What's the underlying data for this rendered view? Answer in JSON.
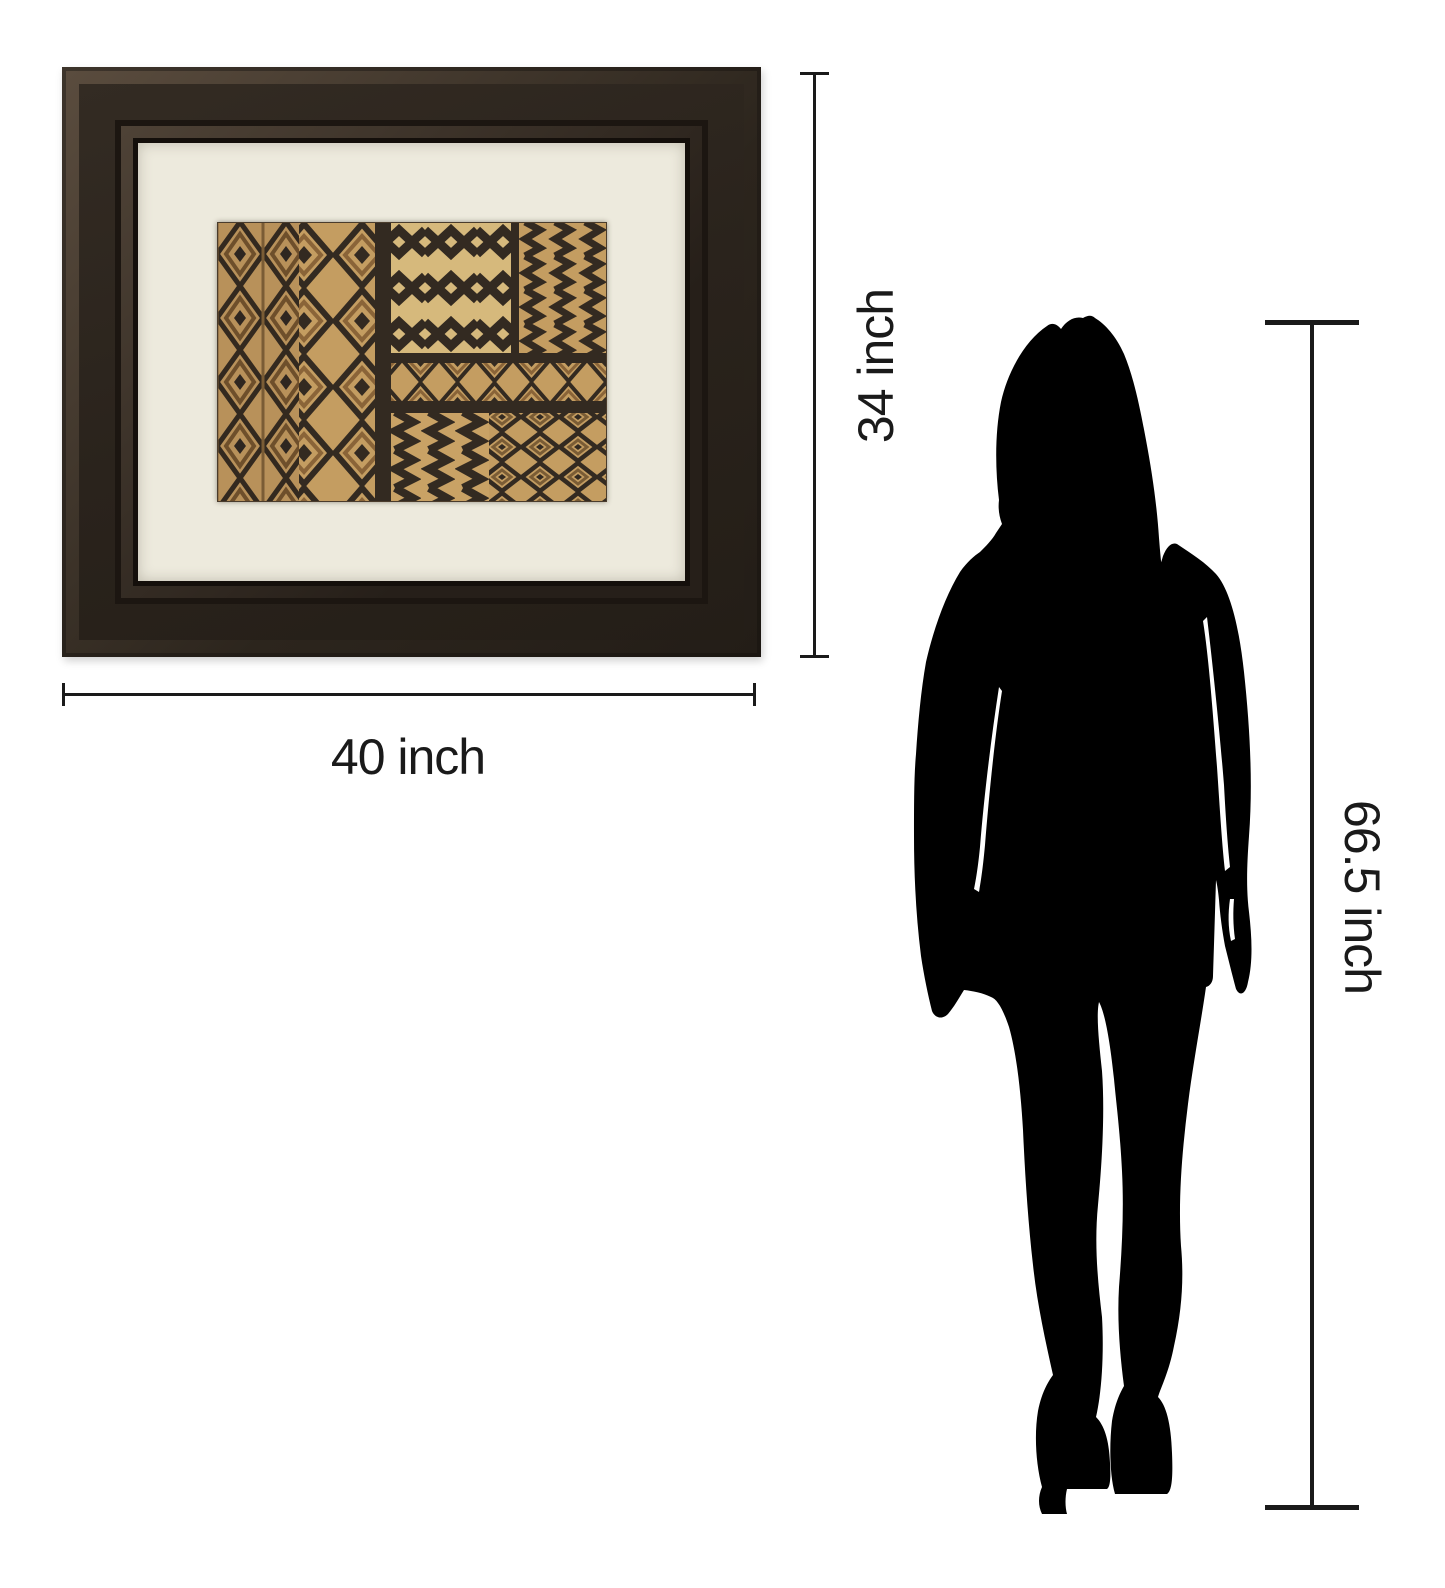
{
  "page": {
    "background_color": "#ffffff"
  },
  "artwork": {
    "description": "framed African kuba-pattern print",
    "frame_color": "#2a231c",
    "mat_color": "#edeadd",
    "pattern_base_color": "#c49d61",
    "pattern_dark_color": "#332a21"
  },
  "dimension_labels": {
    "frame_height": "34 inch",
    "frame_width": "40 inch",
    "person_height": "66.5 inch"
  },
  "person": {
    "description": "woman silhouette for scale",
    "color": "#000000"
  }
}
